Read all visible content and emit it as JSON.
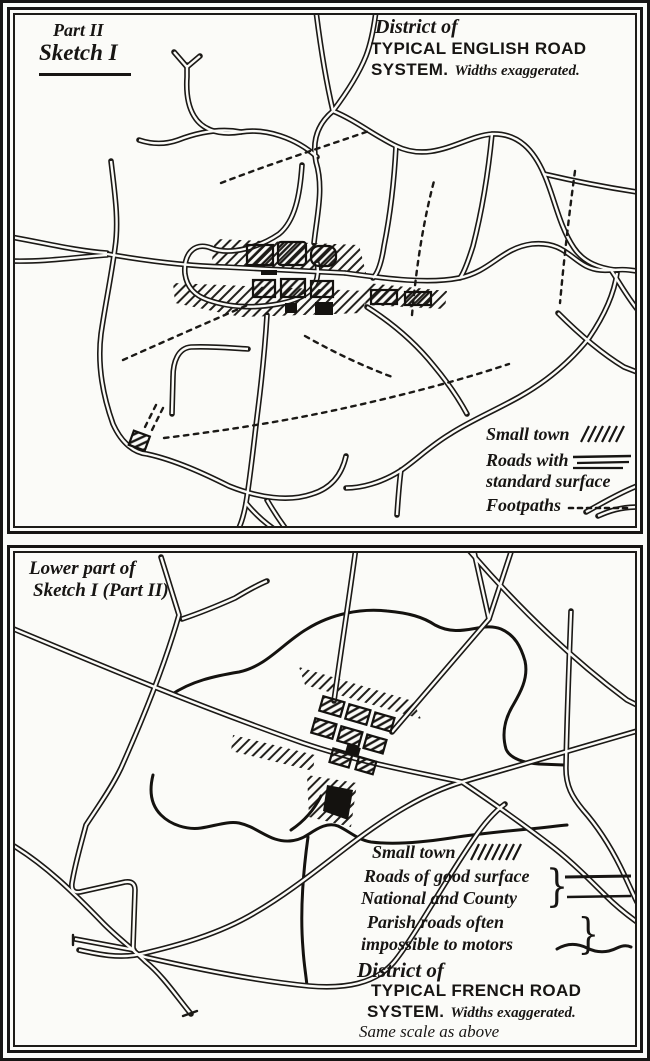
{
  "colors": {
    "ink": "#171513",
    "paper": "#fbfbf8"
  },
  "glyphs": {
    "brace": "}"
  },
  "panel_english": {
    "part_label": "Part II",
    "sketch_label": "Sketch I",
    "title_line1": "District of",
    "title_line2": "TYPICAL ENGLISH ROAD",
    "title_line3": "SYSTEM.",
    "title_note": "Widths exaggerated.",
    "legend": {
      "small_town": "Small town",
      "roads_line1": "Roads with",
      "roads_line2": "standard surface",
      "footpaths": "Footpaths"
    }
  },
  "panel_french": {
    "caption_line1": "Lower part of",
    "caption_line2": "Sketch I (Part II)",
    "legend": {
      "small_town": "Small town",
      "roads_line1": "Roads of good surface",
      "roads_line2": "National and County",
      "parish_line1": "Parish roads often",
      "parish_line2": "impossible to motors"
    },
    "title_line1": "District of",
    "title_line2": "TYPICAL FRENCH ROAD",
    "title_line3": "SYSTEM.",
    "title_note": "Widths exaggerated.",
    "title_note2": "Same scale as above"
  }
}
